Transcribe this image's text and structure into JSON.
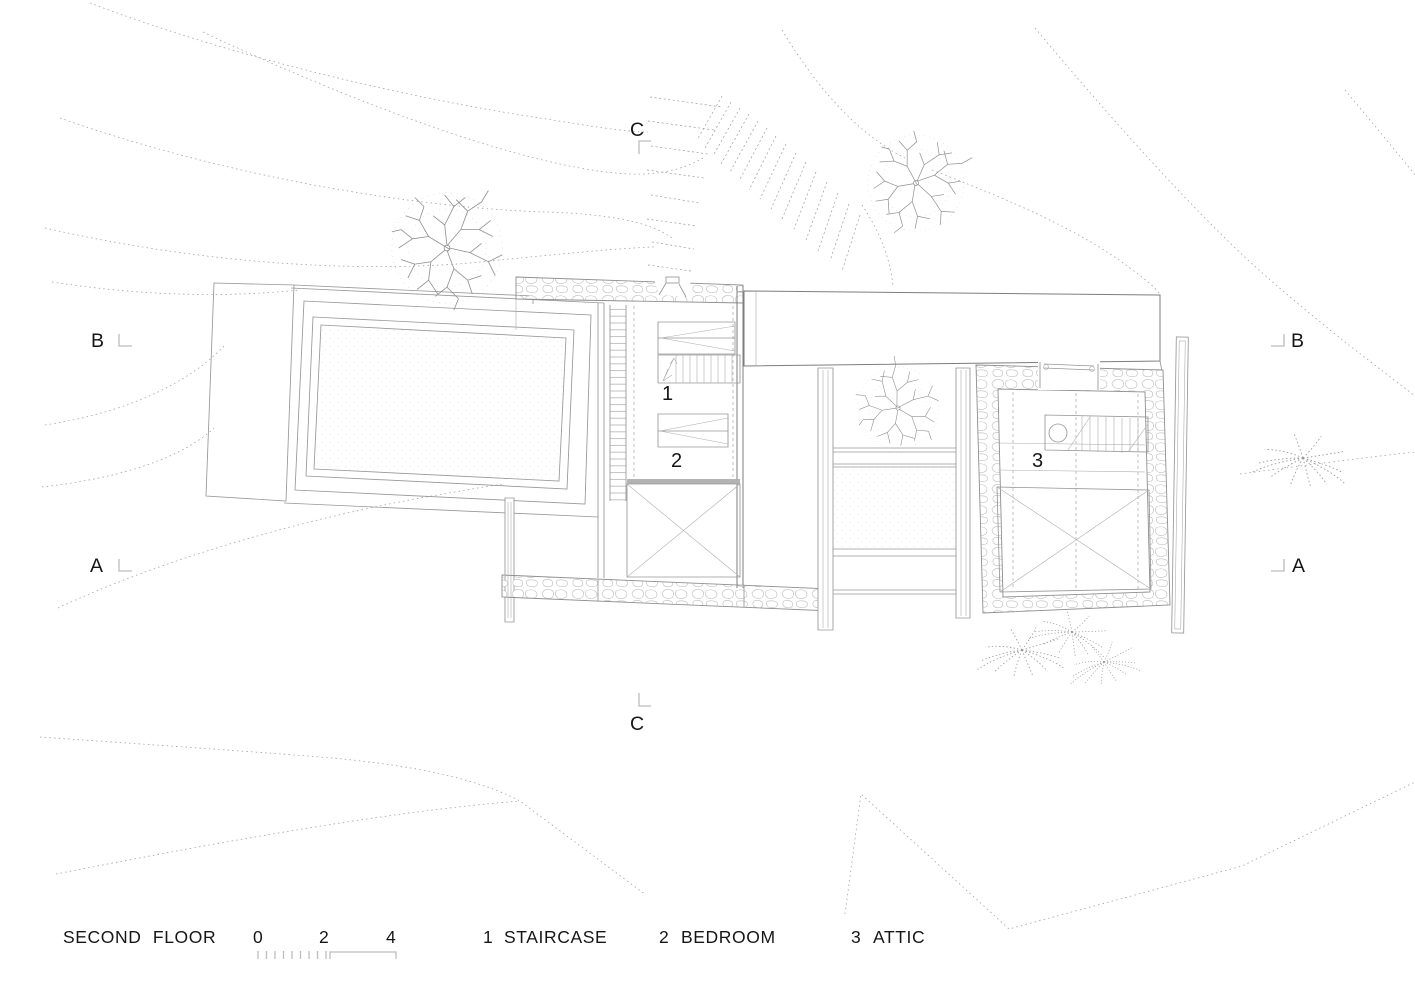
{
  "title": {
    "label": "SECOND FLOOR"
  },
  "scale_bar": {
    "tick_labels": [
      "0",
      "2",
      "4"
    ]
  },
  "legend": {
    "items": [
      {
        "number": "1",
        "label": "STAIRCASE"
      },
      {
        "number": "2",
        "label": "BEDROOM"
      },
      {
        "number": "3",
        "label": "ATTIC"
      }
    ]
  },
  "section_markers": {
    "c_top": "C",
    "c_bottom": "C",
    "b_left": "B",
    "b_right": "B",
    "a_left": "A",
    "a_right": "A"
  },
  "room_labels": {
    "staircase": "1",
    "bedroom": "2",
    "attic": "3"
  },
  "colors": {
    "background": "#ffffff",
    "building_line": "#7e7e7e",
    "detail_line": "#979797",
    "contour_line": "#a2a2a2",
    "stone_hatch": "#bcbcbc",
    "beam_fill": "#b3b3b3",
    "text": "#161616"
  }
}
